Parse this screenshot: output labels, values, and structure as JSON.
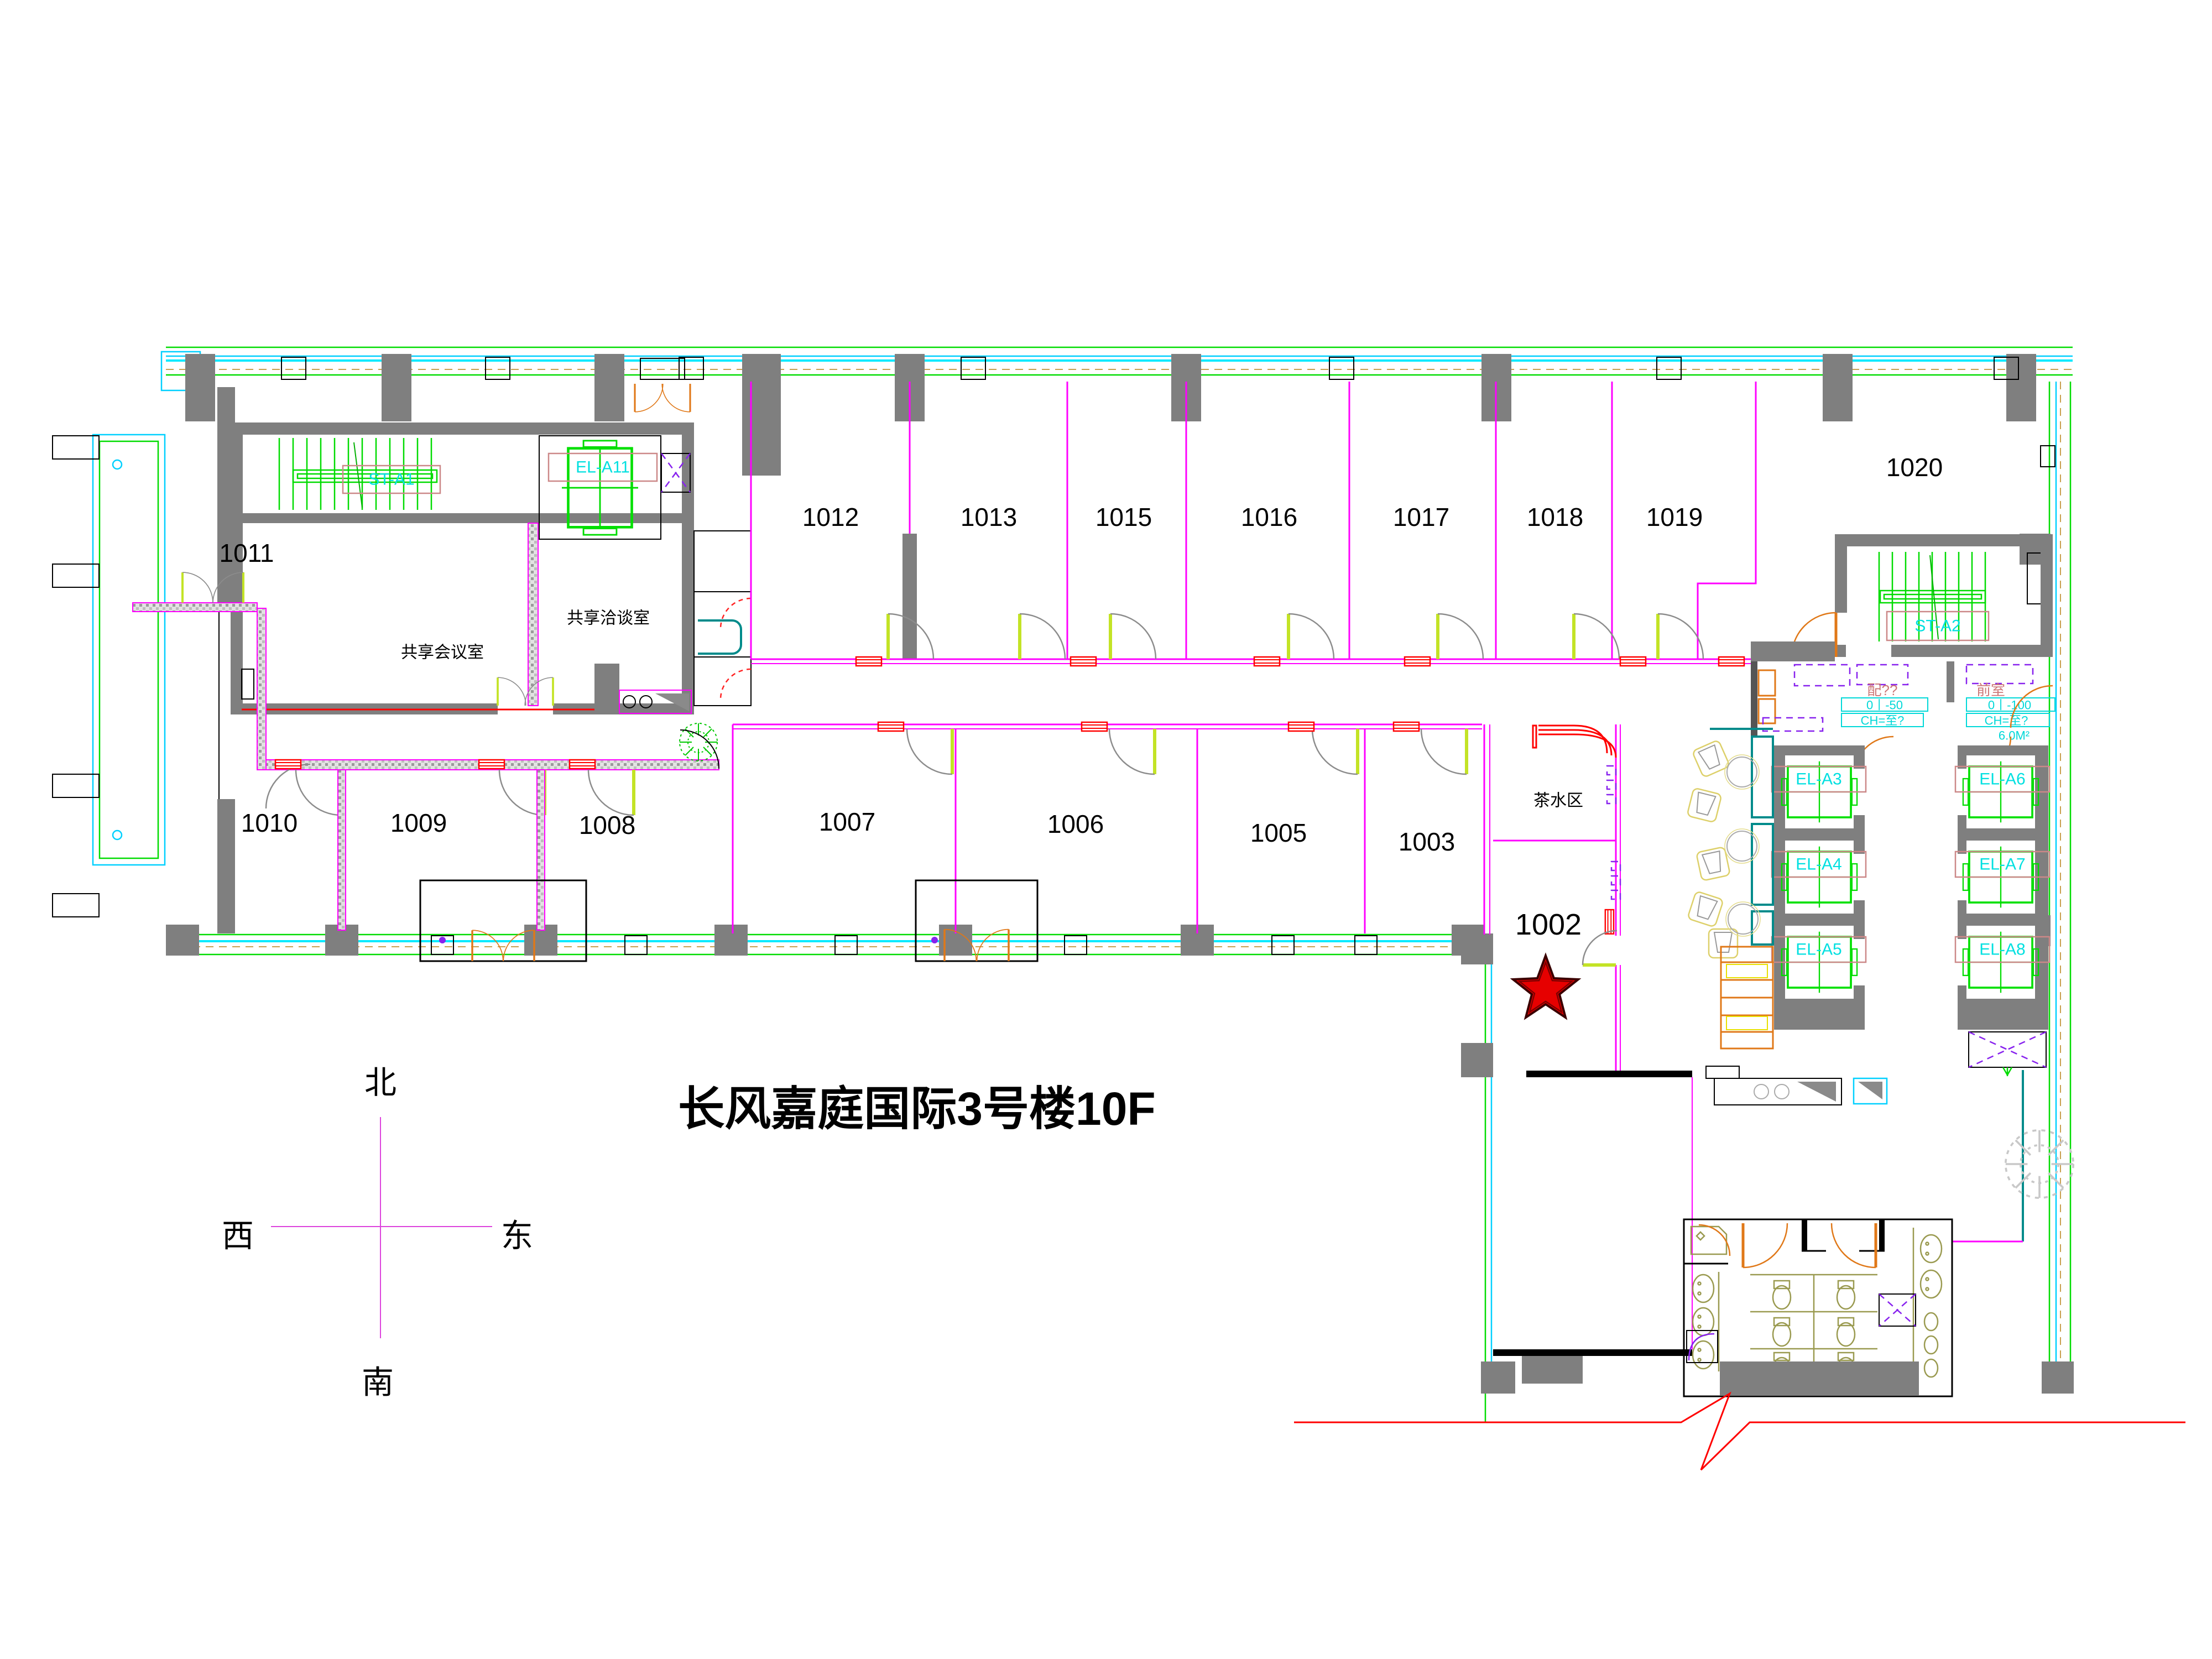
{
  "title": "长风嘉庭国际3号楼10F",
  "compass": {
    "north": "北",
    "south": "南",
    "west": "西",
    "east": "东"
  },
  "rooms": {
    "r1002": "1002",
    "r1003": "1003",
    "r1005": "1005",
    "r1006": "1006",
    "r1007": "1007",
    "r1008": "1008",
    "r1009": "1009",
    "r1010": "1010",
    "r1011": "1011",
    "r1012": "1012",
    "r1013": "1013",
    "r1015": "1015",
    "r1016": "1016",
    "r1017": "1017",
    "r1018": "1018",
    "r1019": "1019",
    "r1020": "1020"
  },
  "areas": {
    "shared_meeting_room": "共享会议室",
    "shared_negotiation_room": "共享洽谈室",
    "tea_area": "茶水区",
    "anteroom": "前室",
    "electrical_room": "配??"
  },
  "stairs": {
    "st_a1": "ST-A1",
    "st_a2": "ST-A2"
  },
  "elevators": {
    "el_a11": "EL-A11",
    "el_a3": "EL-A3",
    "el_a4": "EL-A4",
    "el_a5": "EL-A5",
    "el_a6": "EL-A6",
    "el_a7": "EL-A7",
    "el_a8": "EL-A8"
  },
  "annotations": {
    "electrical_size": "0丨-50",
    "electrical_ch": "CH=至?",
    "anteroom_size": "0丨-100",
    "anteroom_ch": "CH=至?",
    "anteroom_area": "6.0M²"
  },
  "marker": {
    "shape": "star",
    "color": "#e60000"
  }
}
